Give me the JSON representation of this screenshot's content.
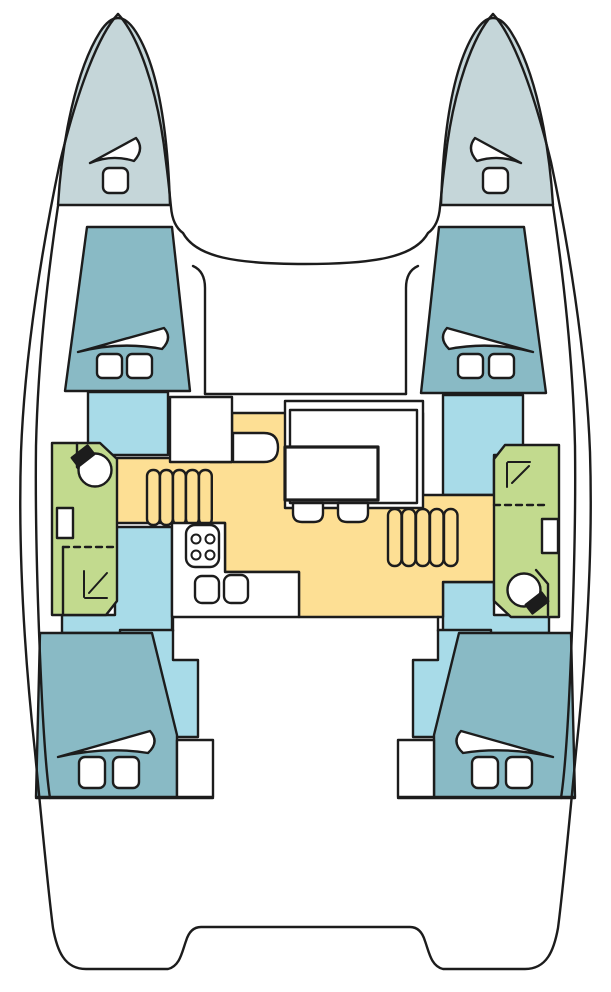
{
  "diagram": {
    "type": "boat-floorplan",
    "vessel": "catamaran",
    "view": "top-down deck plan"
  },
  "colors": {
    "outline": "#1c1c1c",
    "white": "#ffffff",
    "bow": "#c5d6d9",
    "cabin": "#89bac5",
    "passage": "#a8dbe8",
    "salon": "#fddf94",
    "bathroom": "#c2da8e"
  },
  "legend": {
    "bow": "bow-locker",
    "cabin": "sleeping-cabin",
    "passage": "hull-companionway",
    "salon": "saloon-and-galley",
    "bathroom": "head-with-shower",
    "white": "deck-and-furniture"
  },
  "counts": {
    "bow_lockers": 2,
    "cabins": 4,
    "bathrooms": 2,
    "stair_flights": 2,
    "beds": 6
  }
}
